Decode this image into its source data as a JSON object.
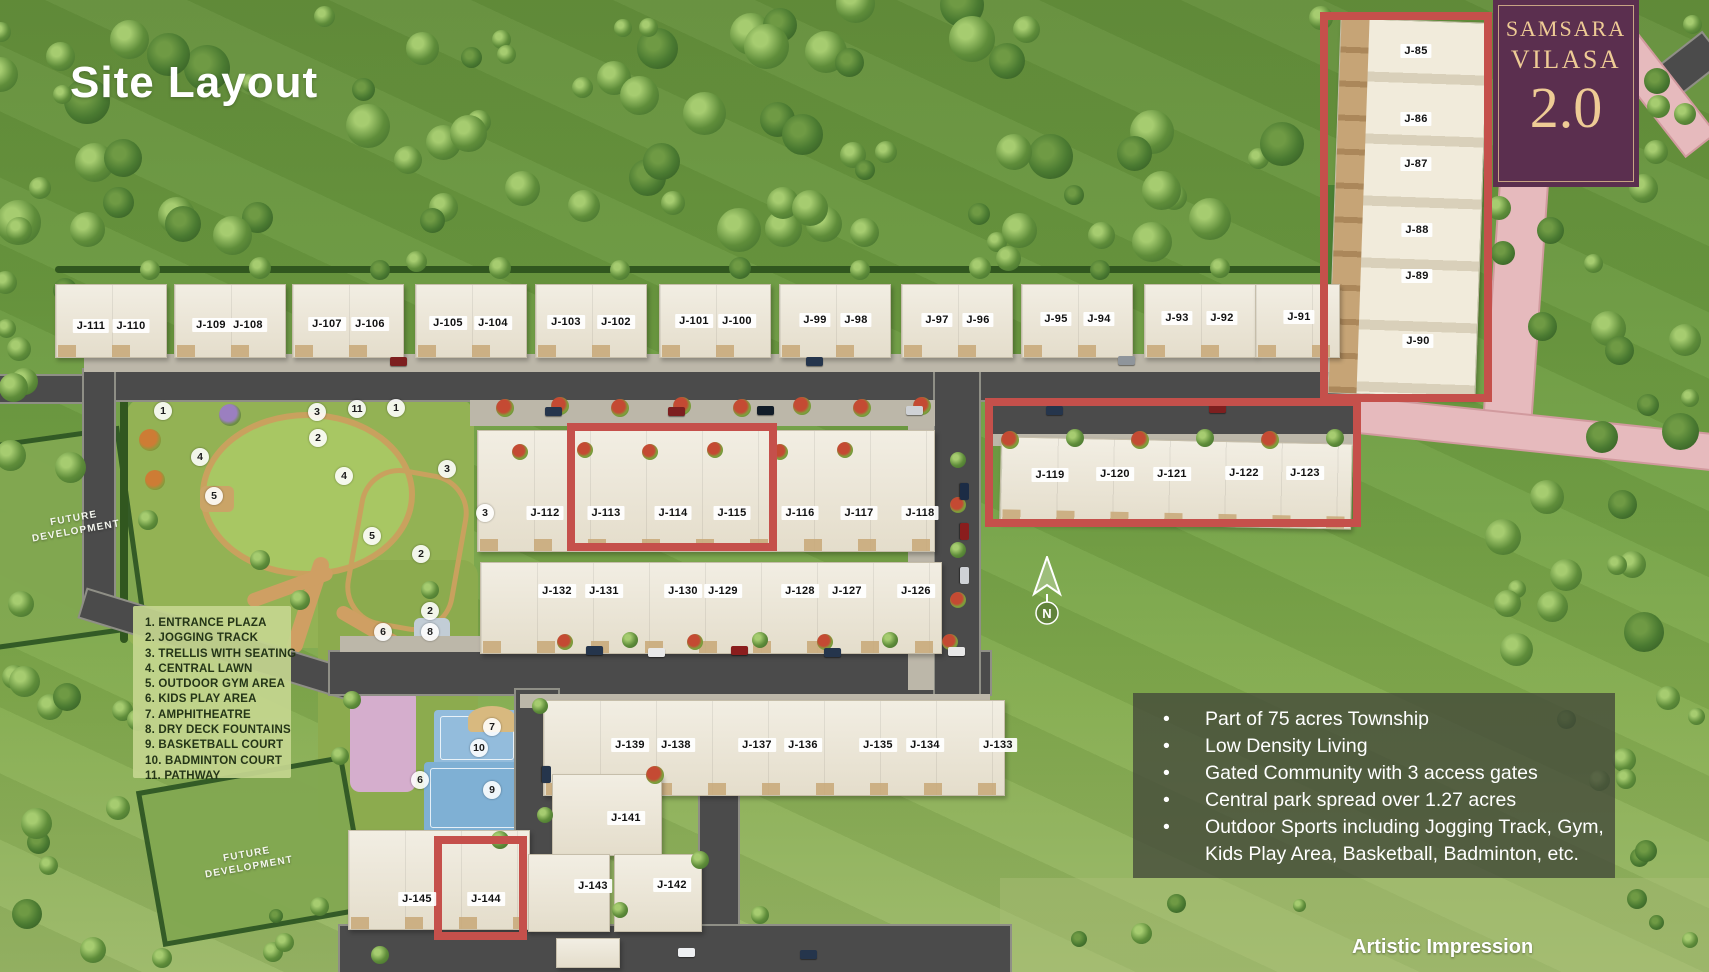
{
  "title": "Site Layout",
  "logo": {
    "brand_line1": "SAMSARA",
    "brand_line2": "VILASA",
    "version": "2.0"
  },
  "watermark": "Artistic Impression",
  "compass": {
    "label": "N"
  },
  "future_development": {
    "line1": "FUTURE",
    "line2": "DEVELOPMENT"
  },
  "colors": {
    "accent_red": "#c5504b",
    "logo_bg": "#5b2f4f",
    "logo_gold": "#eecb95",
    "road": "#4b4b4b",
    "pink_road": "#e6babd"
  },
  "legend": {
    "items": [
      "1. ENTRANCE PLAZA",
      "2. JOGGING TRACK",
      "3. TRELLIS WITH SEATING",
      "4. CENTRAL LAWN",
      "5. OUTDOOR GYM AREA",
      "6. KIDS PLAY AREA",
      "7. AMPHITHEATRE",
      "8. DRY DECK FOUNTAINS",
      "9. BASKETBALL COURT",
      "10. BADMINTON COURT",
      "11. PATHWAY"
    ]
  },
  "info_panel": {
    "bullets": [
      "Part of 75 acres Township",
      "Low Density Living",
      "Gated Community with 3 access gates",
      "Central park spread over 1.27 acres",
      "Outdoor Sports including Jogging Track, Gym, Kids Play Area, Basketball, Badminton, etc."
    ]
  },
  "unit_labels": [
    {
      "label": "J-111",
      "x": 91,
      "y": 326
    },
    {
      "label": "J-110",
      "x": 131,
      "y": 326
    },
    {
      "label": "J-109",
      "x": 211,
      "y": 325
    },
    {
      "label": "J-108",
      "x": 248,
      "y": 325
    },
    {
      "label": "J-107",
      "x": 327,
      "y": 324
    },
    {
      "label": "J-106",
      "x": 370,
      "y": 324
    },
    {
      "label": "J-105",
      "x": 448,
      "y": 323
    },
    {
      "label": "J-104",
      "x": 493,
      "y": 323
    },
    {
      "label": "J-103",
      "x": 566,
      "y": 322
    },
    {
      "label": "J-102",
      "x": 616,
      "y": 322
    },
    {
      "label": "J-101",
      "x": 694,
      "y": 321
    },
    {
      "label": "J-100",
      "x": 737,
      "y": 321
    },
    {
      "label": "J-99",
      "x": 815,
      "y": 320
    },
    {
      "label": "J-98",
      "x": 856,
      "y": 320
    },
    {
      "label": "J-97",
      "x": 937,
      "y": 320
    },
    {
      "label": "J-96",
      "x": 978,
      "y": 320
    },
    {
      "label": "J-95",
      "x": 1056,
      "y": 319
    },
    {
      "label": "J-94",
      "x": 1099,
      "y": 319
    },
    {
      "label": "J-93",
      "x": 1177,
      "y": 318
    },
    {
      "label": "J-92",
      "x": 1222,
      "y": 318
    },
    {
      "label": "J-91",
      "x": 1299,
      "y": 317
    },
    {
      "label": "J-85",
      "x": 1416,
      "y": 51
    },
    {
      "label": "J-86",
      "x": 1416,
      "y": 119
    },
    {
      "label": "J-87",
      "x": 1416,
      "y": 164
    },
    {
      "label": "J-88",
      "x": 1417,
      "y": 230
    },
    {
      "label": "J-89",
      "x": 1417,
      "y": 276
    },
    {
      "label": "J-90",
      "x": 1418,
      "y": 341
    },
    {
      "label": "J-112",
      "x": 545,
      "y": 513
    },
    {
      "label": "J-113",
      "x": 606,
      "y": 513
    },
    {
      "label": "J-114",
      "x": 673,
      "y": 513
    },
    {
      "label": "J-115",
      "x": 732,
      "y": 513
    },
    {
      "label": "J-116",
      "x": 800,
      "y": 513
    },
    {
      "label": "J-117",
      "x": 859,
      "y": 513
    },
    {
      "label": "J-118",
      "x": 920,
      "y": 513
    },
    {
      "label": "J-119",
      "x": 1050,
      "y": 475
    },
    {
      "label": "J-120",
      "x": 1115,
      "y": 474
    },
    {
      "label": "J-121",
      "x": 1172,
      "y": 474
    },
    {
      "label": "J-122",
      "x": 1244,
      "y": 473
    },
    {
      "label": "J-123",
      "x": 1305,
      "y": 473
    },
    {
      "label": "J-132",
      "x": 557,
      "y": 591
    },
    {
      "label": "J-131",
      "x": 604,
      "y": 591
    },
    {
      "label": "J-130",
      "x": 683,
      "y": 591
    },
    {
      "label": "J-129",
      "x": 723,
      "y": 591
    },
    {
      "label": "J-128",
      "x": 800,
      "y": 591
    },
    {
      "label": "J-127",
      "x": 847,
      "y": 591
    },
    {
      "label": "J-126",
      "x": 916,
      "y": 591
    },
    {
      "label": "J-139",
      "x": 630,
      "y": 745
    },
    {
      "label": "J-138",
      "x": 676,
      "y": 745
    },
    {
      "label": "J-137",
      "x": 757,
      "y": 745
    },
    {
      "label": "J-136",
      "x": 803,
      "y": 745
    },
    {
      "label": "J-135",
      "x": 878,
      "y": 745
    },
    {
      "label": "J-134",
      "x": 925,
      "y": 745
    },
    {
      "label": "J-133",
      "x": 998,
      "y": 745
    },
    {
      "label": "J-141",
      "x": 626,
      "y": 818
    },
    {
      "label": "J-143",
      "x": 593,
      "y": 886
    },
    {
      "label": "J-142",
      "x": 672,
      "y": 885
    },
    {
      "label": "J-145",
      "x": 417,
      "y": 899
    },
    {
      "label": "J-144",
      "x": 486,
      "y": 899
    }
  ],
  "park_markers": [
    {
      "label": "1",
      "x": 163,
      "y": 411
    },
    {
      "label": "3",
      "x": 317,
      "y": 412
    },
    {
      "label": "11",
      "x": 357,
      "y": 409
    },
    {
      "label": "1",
      "x": 396,
      "y": 408
    },
    {
      "label": "2",
      "x": 318,
      "y": 438
    },
    {
      "label": "4",
      "x": 200,
      "y": 457
    },
    {
      "label": "3",
      "x": 447,
      "y": 469
    },
    {
      "label": "4",
      "x": 344,
      "y": 476
    },
    {
      "label": "5",
      "x": 214,
      "y": 496
    },
    {
      "label": "3",
      "x": 485,
      "y": 513
    },
    {
      "label": "5",
      "x": 372,
      "y": 536
    },
    {
      "label": "2",
      "x": 421,
      "y": 554
    },
    {
      "label": "2",
      "x": 430,
      "y": 611
    },
    {
      "label": "6",
      "x": 383,
      "y": 632
    },
    {
      "label": "8",
      "x": 430,
      "y": 632
    },
    {
      "label": "7",
      "x": 492,
      "y": 727
    },
    {
      "label": "10",
      "x": 479,
      "y": 748
    },
    {
      "label": "6",
      "x": 420,
      "y": 780
    },
    {
      "label": "9",
      "x": 492,
      "y": 790
    }
  ]
}
